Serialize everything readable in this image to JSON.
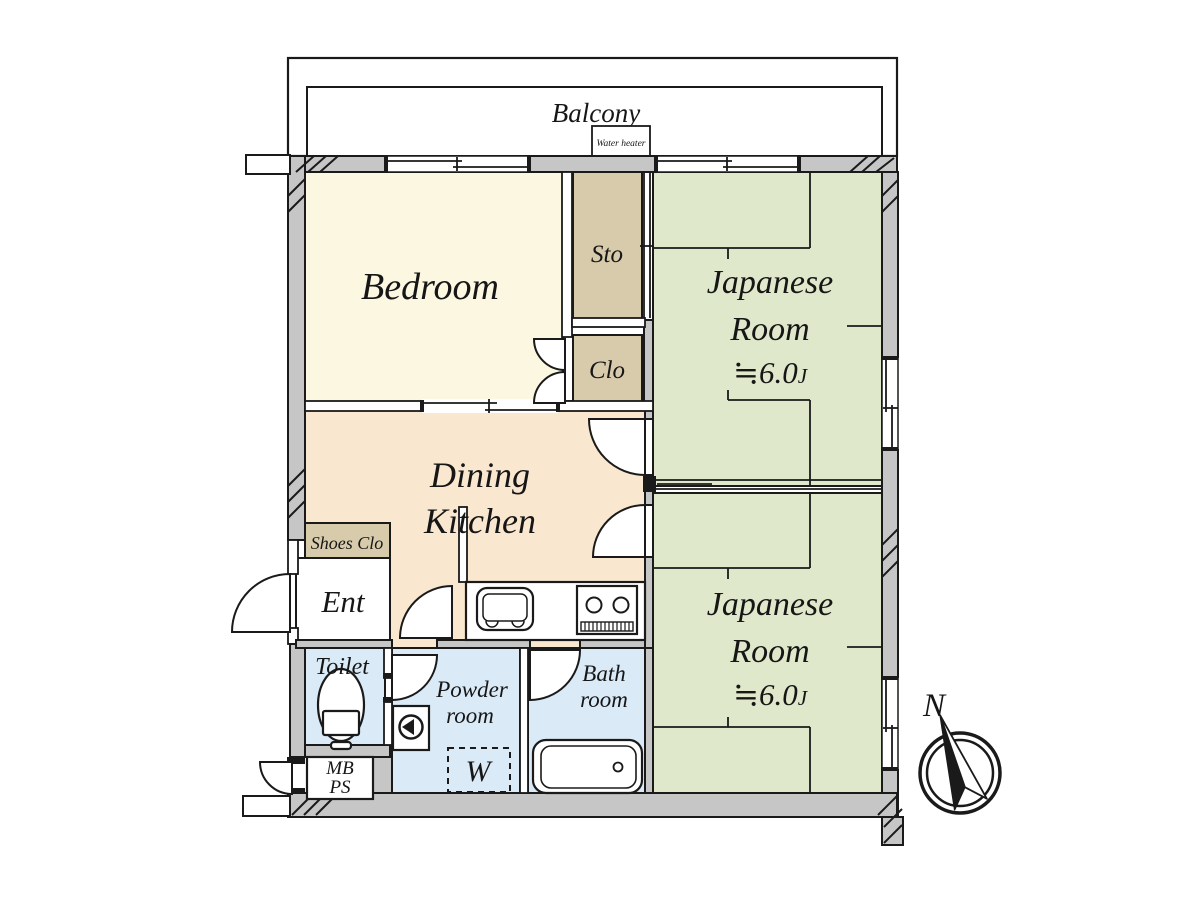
{
  "plan_title": "Apartment floor plan",
  "colors": {
    "wall_fill": "#c6c6c6",
    "outline": "#1a1a1a",
    "bedroom_floor": "#fbf7e0",
    "closet_floor": "#d8cbab",
    "tatami_floor": "#dfe8ca",
    "dining_floor": "#fae7d0",
    "wet_area_floor": "#daeaf7",
    "white": "#ffffff"
  },
  "balcony": {
    "label": "Balcony"
  },
  "water_heater": {
    "label": "Water heater"
  },
  "rooms": {
    "bedroom": {
      "label": "Bedroom"
    },
    "sto": {
      "label": "Sto"
    },
    "clo": {
      "label": "Clo"
    },
    "japanese_room_1": {
      "line1": "Japanese",
      "line2": "Room",
      "size": "≒6.0",
      "size_unit": "J"
    },
    "japanese_room_2": {
      "line1": "Japanese",
      "line2": "Room",
      "size": "≒6.0",
      "size_unit": "J"
    },
    "dining_kitchen": {
      "line1": "Dining",
      "line2": "Kitchen"
    },
    "shoes_clo": {
      "label": "Shoes Clo"
    },
    "entrance": {
      "label": "Ent"
    },
    "toilet": {
      "label": "Toilet"
    },
    "powder_room": {
      "line1": "Powder",
      "line2": "room"
    },
    "bath_room": {
      "line1": "Bath",
      "line2": "room"
    },
    "mb_ps": {
      "line1": "MB",
      "line2": "PS"
    },
    "washing_machine": {
      "label": "W"
    }
  },
  "compass": {
    "label": "N"
  }
}
